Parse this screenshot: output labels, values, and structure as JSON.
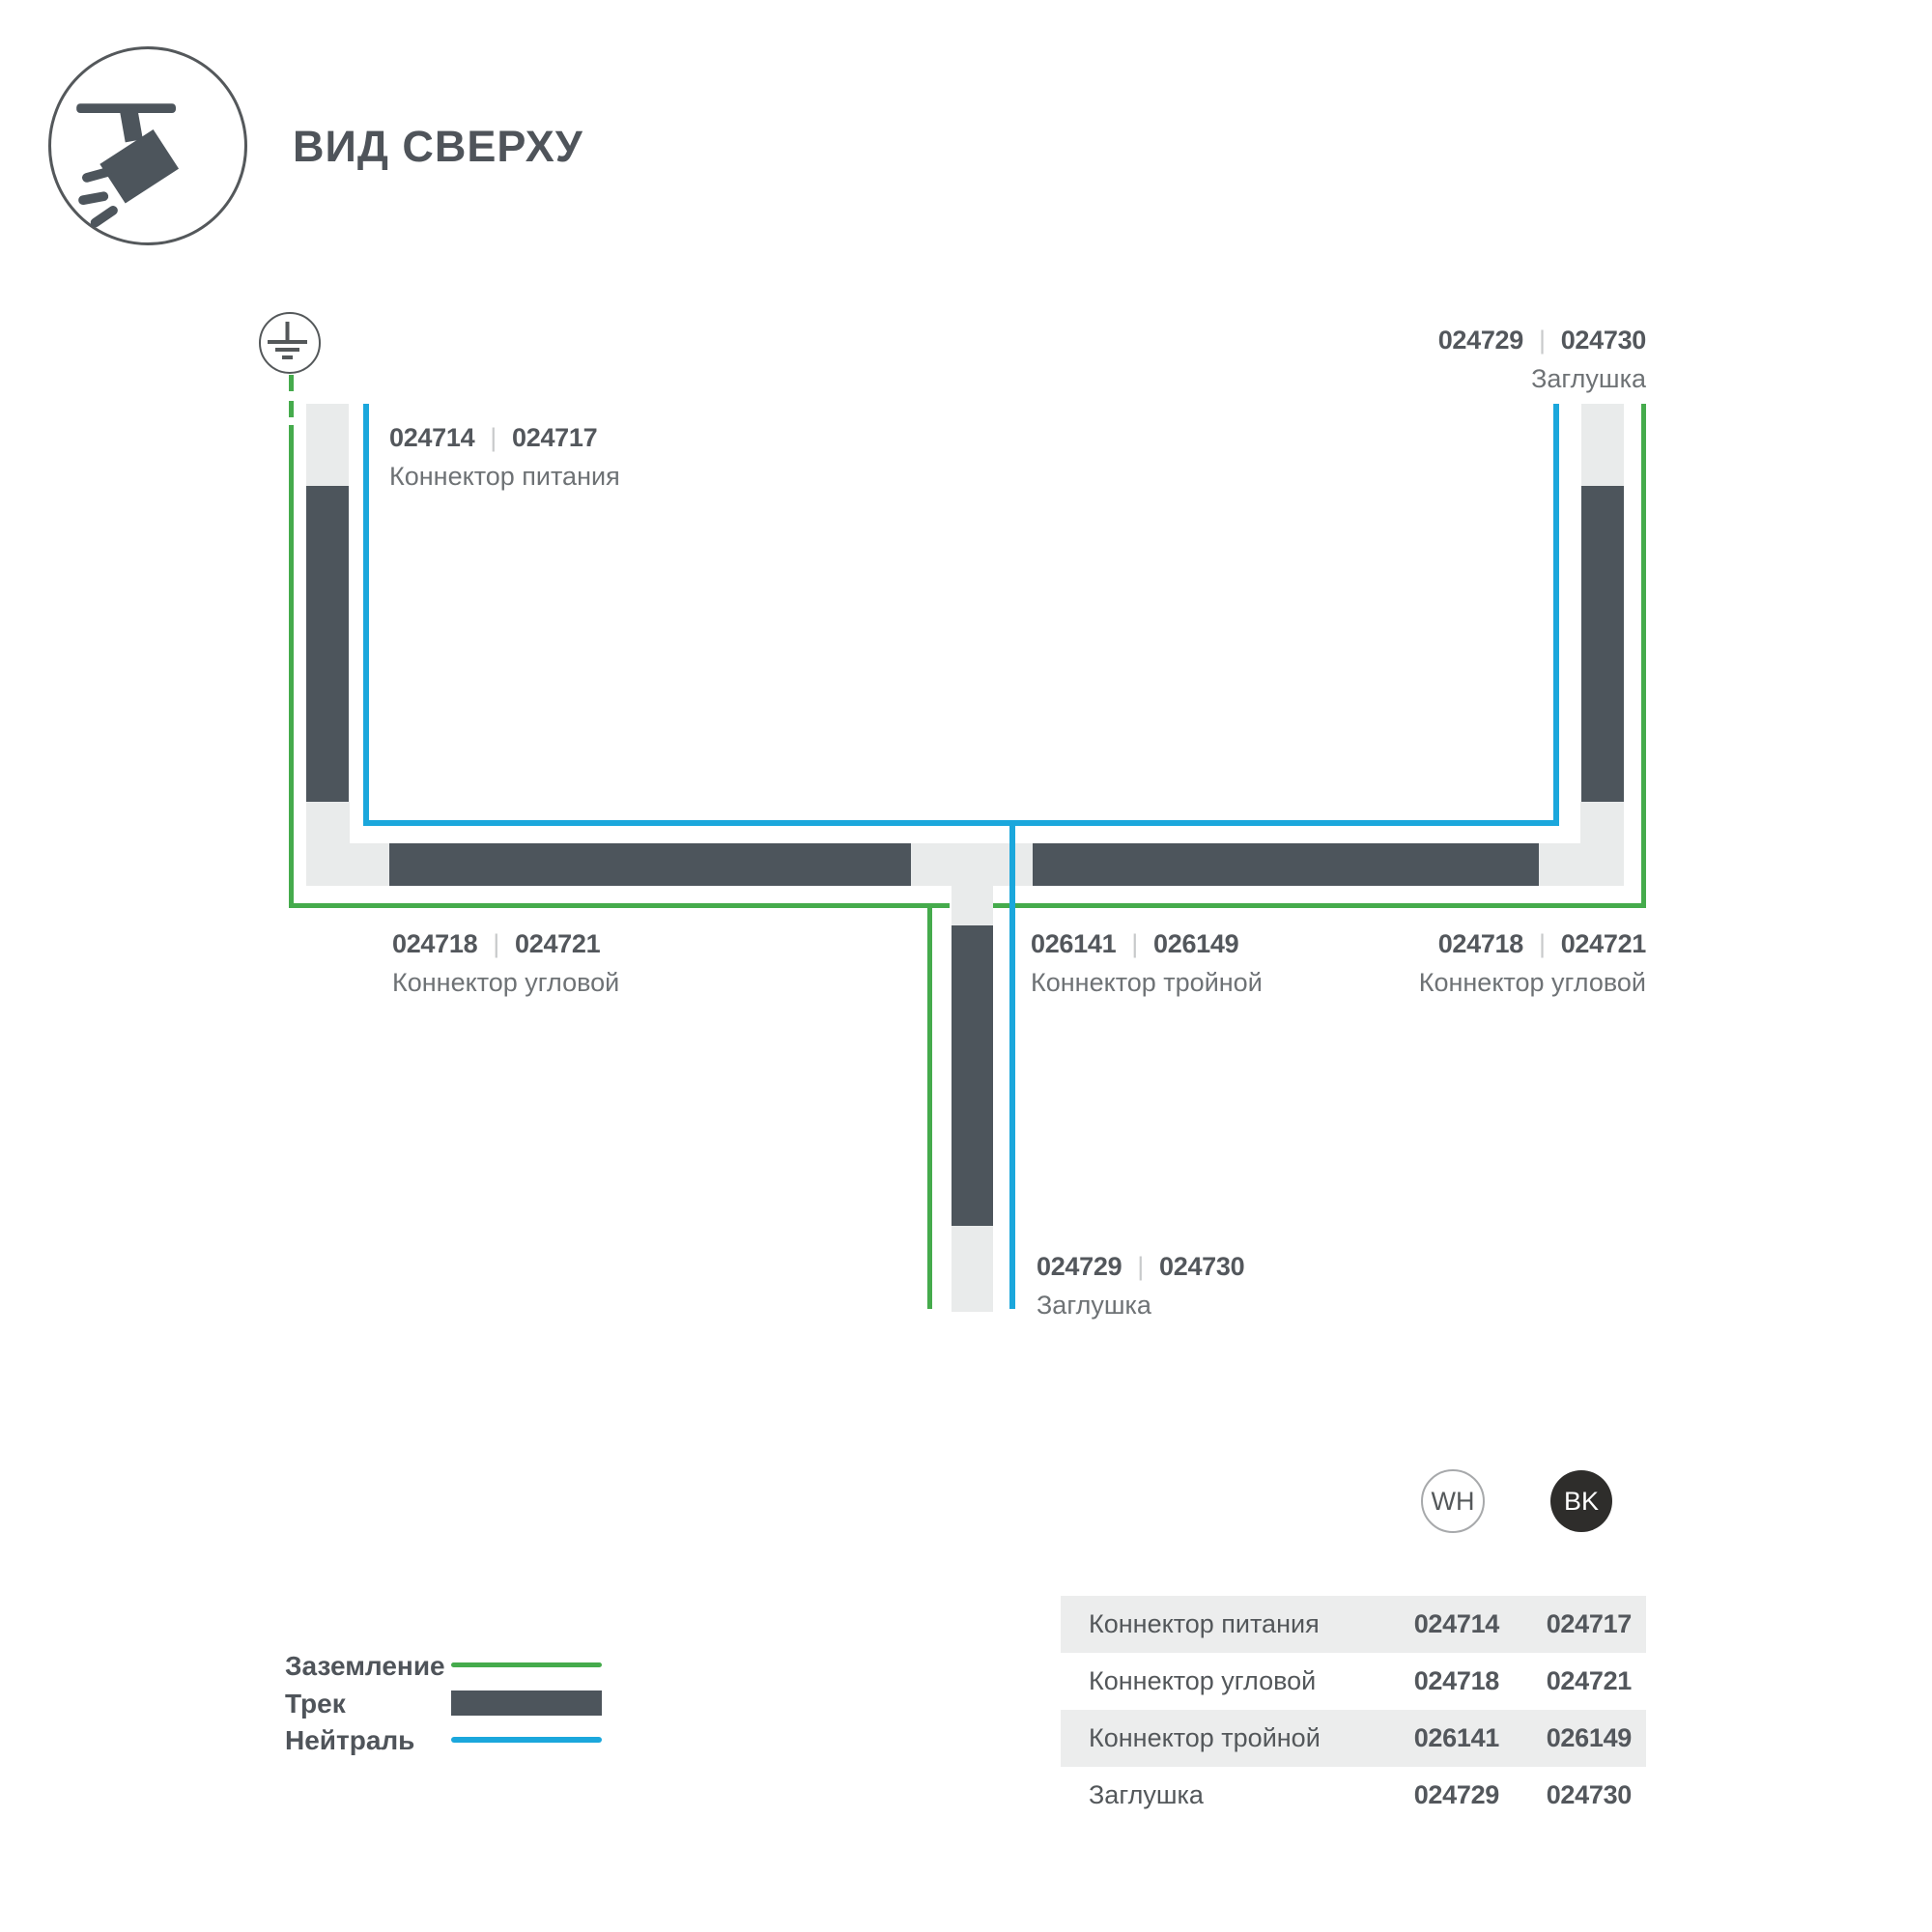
{
  "header": {
    "title": "ВИД СВЕРХУ"
  },
  "diagram": {
    "separator": "|",
    "labels": {
      "power": {
        "code_wh": "024714",
        "code_bk": "024717",
        "caption": "Коннектор питания"
      },
      "cap_top_right": {
        "code_wh": "024729",
        "code_bk": "024730",
        "caption": "Заглушка"
      },
      "corner_left": {
        "code_wh": "024718",
        "code_bk": "024721",
        "caption": "Коннектор угловой"
      },
      "triple": {
        "code_wh": "026141",
        "code_bk": "026149",
        "caption": "Коннектор тройной"
      },
      "corner_right": {
        "code_wh": "024718",
        "code_bk": "024721",
        "caption": "Коннектор угловой"
      },
      "cap_bottom": {
        "code_wh": "024729",
        "code_bk": "024730",
        "caption": "Заглушка"
      }
    }
  },
  "legend": {
    "items": [
      {
        "label": "Заземление",
        "color": "#45AB4C"
      },
      {
        "label": "Трек",
        "color": "#4D555C"
      },
      {
        "label": "Нейтраль",
        "color": "#1BA7DC"
      }
    ]
  },
  "variants": {
    "wh": "WH",
    "bk": "BK"
  },
  "table": {
    "rows": [
      {
        "label": "Коннектор питания",
        "wh": "024714",
        "bk": "024717"
      },
      {
        "label": "Коннектор угловой",
        "wh": "024718",
        "bk": "024721"
      },
      {
        "label": "Коннектор тройной",
        "wh": "026141",
        "bk": "026149"
      },
      {
        "label": "Заглушка",
        "wh": "024729",
        "bk": "024730"
      }
    ]
  },
  "colors": {
    "track": "#4D555C",
    "ground_line": "#45AB4C",
    "neutral_line": "#1BA7DC",
    "connector_piece": "#E9EBEB",
    "text_dark": "#53575C",
    "text_caption": "#6E7275",
    "table_row_shade": "#ECEDED",
    "bk_chip": "#2E2D2B"
  }
}
